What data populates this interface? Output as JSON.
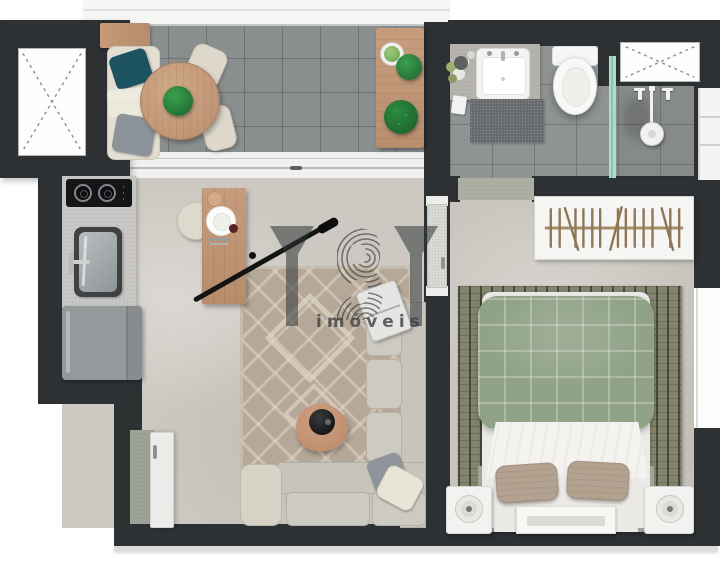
{
  "watermark": {
    "brand": "YBY",
    "tagline": "imóveis"
  },
  "colors": {
    "wall": "#2d3134",
    "floor-living": "#cdc9c2",
    "floor-bedroom": "#c9c5be",
    "tile-balcony": "#8b8e8f",
    "tile-bath": "#909394",
    "wood": "#c49a7b",
    "plant-dark": "#1e6230",
    "cream": "#ddd8cb",
    "teal": "#1d5361",
    "sofa": "#c7c4bb",
    "rug-living": "#b5a898",
    "rug-bedroom": "#83846d",
    "duvet": "#8fa286",
    "pillow-tan": "#b3a290",
    "steel": "#8f9598",
    "fridge": "#96999c",
    "mat": "#9aa094",
    "glass": "#aedbce",
    "watermark": "#2f3437"
  }
}
